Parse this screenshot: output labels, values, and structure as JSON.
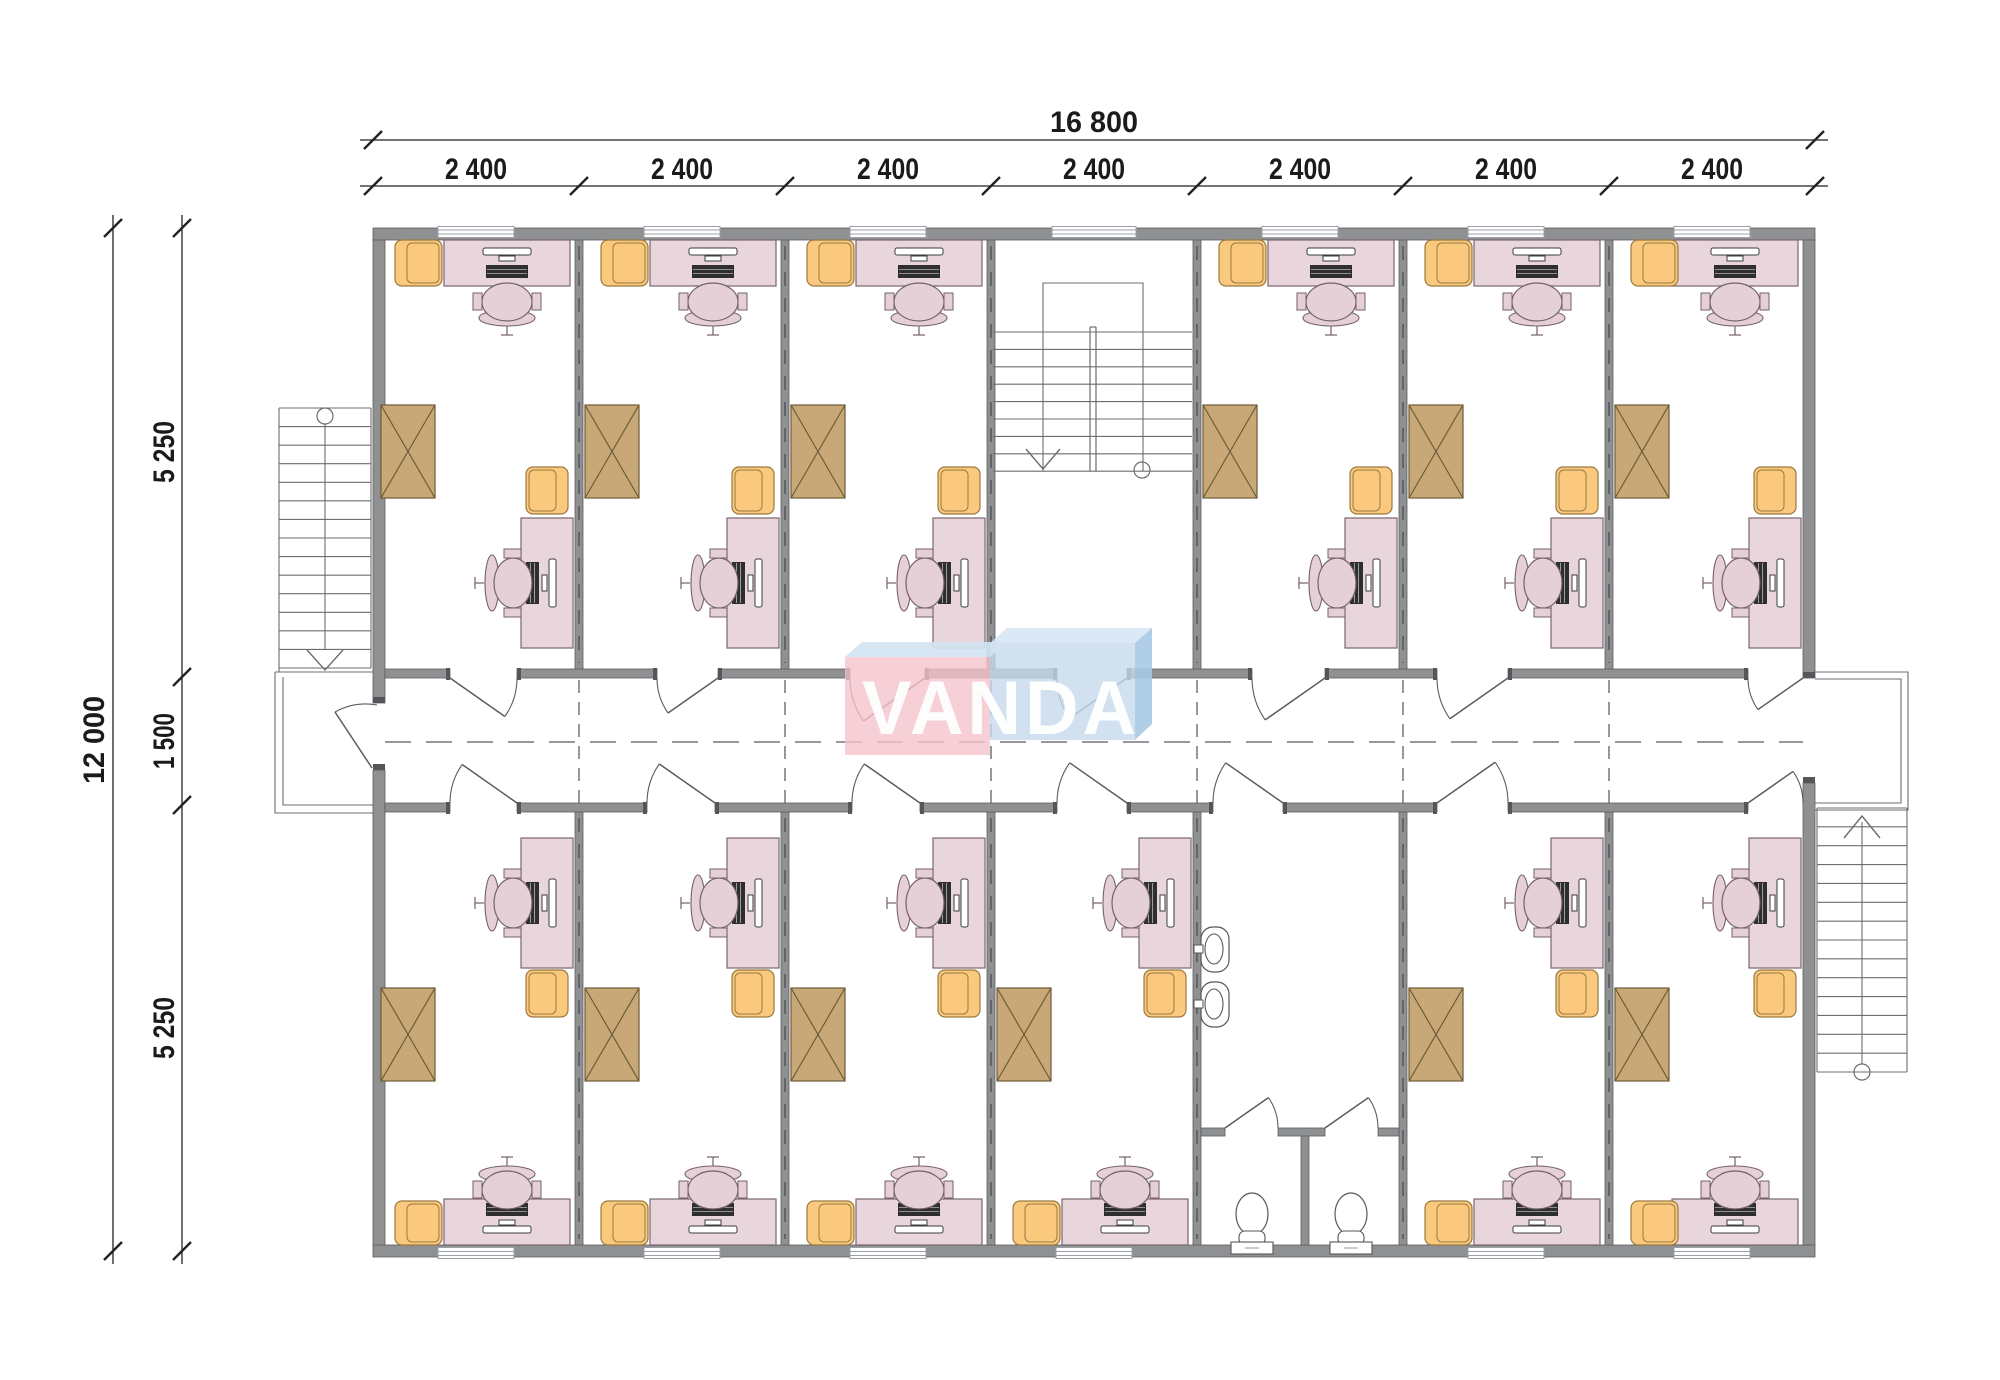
{
  "watermark": {
    "text": "VANDA",
    "front_left": "#f5c3cc",
    "front_right": "#c6daec",
    "flap_top_left": "#d3e3f2",
    "flap_top_right": "#d7e6f5",
    "flap_side": "#a9c9e5",
    "letters": "#ffffff"
  },
  "dimensions": {
    "top_total": "16 800",
    "top_segments": [
      "2 400",
      "2 400",
      "2 400",
      "2 400",
      "2 400",
      "2 400",
      "2 400"
    ],
    "left_total": "12 000",
    "left_segments": [
      "5 250",
      "1 500",
      "5 250"
    ]
  },
  "colors": {
    "background": "#ffffff",
    "wall_fill": "#8e9092",
    "wall_edge": "#5c5e61",
    "wall_cap": "#54565a",
    "wall_dash": "#63656a",
    "thin_line": "#6b6d6f",
    "dash_line": "#75777a",
    "dim_line": "#222222",
    "dim_text": "#1b1b1b",
    "desk_fill": "#e9d6dc",
    "desk_edge": "#7a666e",
    "chair_fill": "#e6d0d8",
    "chair_edge": "#75616a",
    "armchair_fill": "#fbc97e",
    "armchair_edge": "#9a7a40",
    "wardrobe_fill": "#c9a877",
    "wardrobe_edge": "#6e5b36",
    "window_line": "#9aa0a5",
    "device_dark": "#2e2e2e",
    "device_light": "#ffffff",
    "fixture_fill": "#ffffff",
    "fixture_edge": "#55575a"
  }
}
